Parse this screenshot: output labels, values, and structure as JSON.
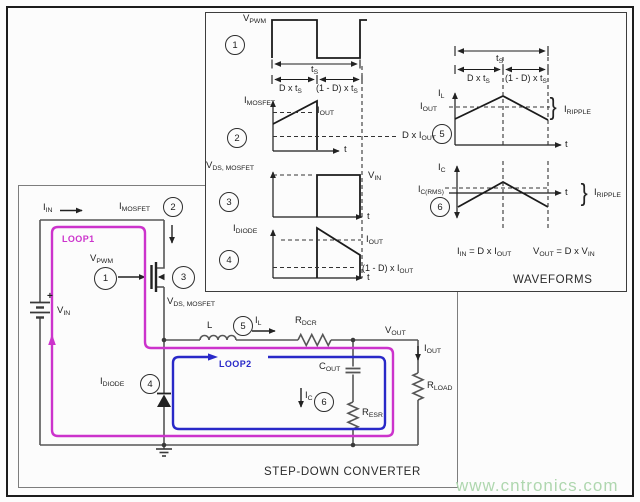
{
  "panels": {
    "waveforms_title": "WAVEFORMS",
    "converter_title": "STEP-DOWN CONVERTER"
  },
  "watermark": "www.cntronics.com",
  "markers": {
    "m1": "1",
    "m2": "2",
    "m3": "3",
    "m4": "4",
    "m5": "5",
    "m6": "6"
  },
  "icons": {
    "brace": "}"
  },
  "labels": {
    "vpwm": {
      "b": "V",
      "s": "PWM"
    },
    "imosfet": {
      "b": "I",
      "s": "MOSFET"
    },
    "vds_mosfet": {
      "b": "V",
      "s": "DS, MOSFET"
    },
    "idiode": {
      "b": "I",
      "s": "DIODE"
    },
    "il": {
      "b": "I",
      "s": "L"
    },
    "ic": {
      "b": "I",
      "s": "C"
    },
    "ic_rms": {
      "b": "I",
      "s": "C(RMS)"
    },
    "iout": {
      "b": "I",
      "s": "OUT"
    },
    "iin": {
      "b": "I",
      "s": "IN"
    },
    "vin": {
      "b": "V",
      "s": "IN"
    },
    "vout": {
      "b": "V",
      "s": "OUT"
    },
    "iripple": {
      "b": "I",
      "s": "RIPPLE"
    },
    "ts": {
      "b": "t",
      "s": "S"
    },
    "d_ts": {
      "b": "D x t",
      "s": "S"
    },
    "omd_ts": {
      "b": "(1 - D) x t",
      "s": "S"
    },
    "d_iout": {
      "b": "D x I",
      "s": "OUT"
    },
    "omd_iout": {
      "b": "(1 - D) x I",
      "s": "OUT"
    },
    "t": "t",
    "plus": "+",
    "inductor": "L",
    "rdcr": {
      "b": "R",
      "s": "DCR"
    },
    "cout": {
      "b": "C",
      "s": "OUT"
    },
    "resr": {
      "b": "R",
      "s": "ESR"
    },
    "rload": {
      "b": "R",
      "s": "LOAD"
    },
    "loop1": "LOOP1",
    "loop2": "LOOP2"
  },
  "equations": {
    "iin_eq": {
      "b1": "I",
      "s1": "IN",
      "b2": " = D x I",
      "s2": "OUT"
    },
    "vout_eq": {
      "b1": "V",
      "s1": "OUT",
      "b2": " = D x V",
      "s2": "IN"
    }
  },
  "colors": {
    "loop1": "#cc33cc",
    "loop2": "#2929c8",
    "watermark": "#afd7af",
    "line": "#565656",
    "wave": "#1b1b1b"
  }
}
